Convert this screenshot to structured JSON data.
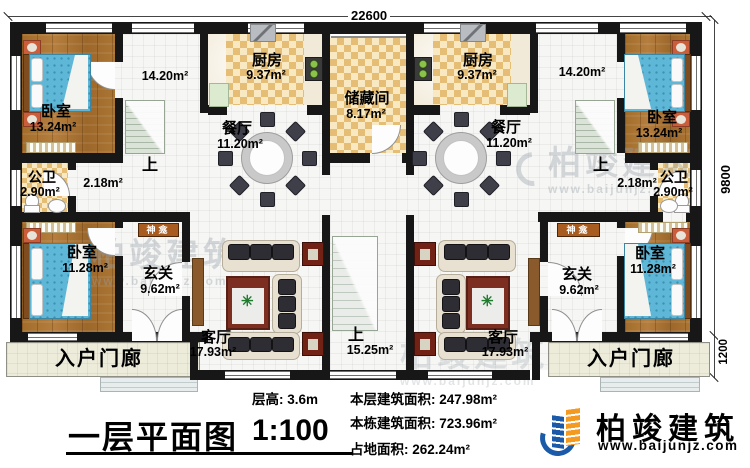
{
  "dimensions": {
    "top": "22600",
    "right_main": "9800",
    "right_porch": "1200"
  },
  "rooms": {
    "bedroom_tl": {
      "name": "卧室",
      "area": "13.24m²"
    },
    "stair_l": {
      "area": "14.20m²",
      "up": "上"
    },
    "kitchen_l": {
      "name": "厨房",
      "area": "9.37m²"
    },
    "dining_l": {
      "name": "餐厅",
      "area": "11.20m²"
    },
    "storage": {
      "name": "储藏间",
      "area": "8.17m²"
    },
    "kitchen_r": {
      "name": "厨房",
      "area": "9.37m²"
    },
    "dining_r": {
      "name": "餐厅",
      "area": "11.20m²"
    },
    "stair_r": {
      "area": "14.20m²",
      "up": "上"
    },
    "bedroom_tr": {
      "name": "卧室",
      "area": "13.24m²"
    },
    "bath_l": {
      "name": "公卫",
      "area": "2.90m²"
    },
    "hall_l": {
      "area": "2.18m²"
    },
    "shrine_l": {
      "name": "神龛"
    },
    "bedroom_bl": {
      "name": "卧室",
      "area": "11.28m²"
    },
    "foyer_l": {
      "name": "玄关",
      "area": "9.62m²"
    },
    "living_l": {
      "name": "客厅",
      "area": "17.93m²"
    },
    "stair_c": {
      "up": "上",
      "area": "15.25m²"
    },
    "living_r": {
      "name": "客厅",
      "area": "17.93m²"
    },
    "foyer_r": {
      "name": "玄关",
      "area": "9.62m²"
    },
    "bedroom_br": {
      "name": "卧室",
      "area": "11.28m²"
    },
    "shrine_r": {
      "name": "神龛"
    },
    "bath_r": {
      "name": "公卫",
      "area": "2.90m²"
    },
    "hall_r": {
      "area": "2.18m²"
    },
    "porch_l": {
      "name": "入户门廊"
    },
    "porch_r": {
      "name": "入户门廊"
    }
  },
  "title_block": {
    "title": "一层平面图",
    "scale": "1:100",
    "floor_height": "层高: 3.6m",
    "floor_area": "本层建筑面积: 247.98m²",
    "building_area": "本栋建筑面积: 723.96m²",
    "land_area": "占地面积: 262.24m²"
  },
  "brand": {
    "name": "柏竣建筑",
    "website": "www.baijunjz.com"
  },
  "watermark": {
    "name": "柏竣建筑",
    "website": "www.baijunjz.com"
  },
  "colors": {
    "wall": "#171717",
    "wood_floor": "#a9722f",
    "tile": "#e6bd74",
    "brand_blue": "#1b5aa8",
    "brand_orange": "#f59a20",
    "shrine": "#a85c20"
  }
}
